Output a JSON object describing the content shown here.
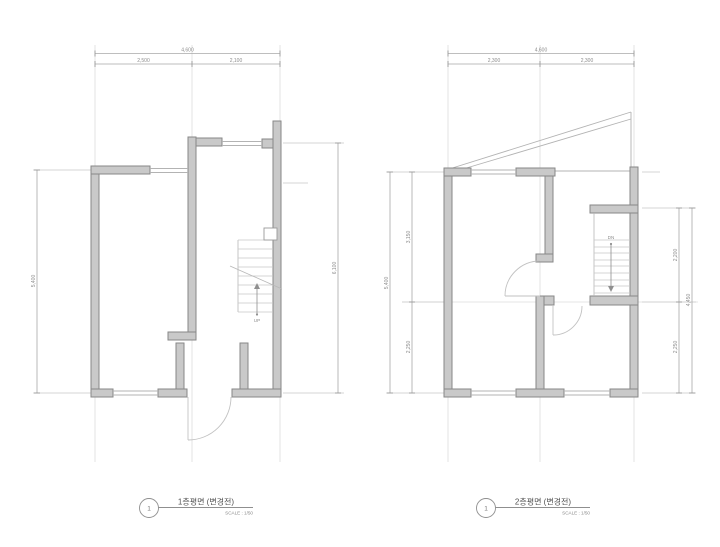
{
  "sheet": {
    "type": "architectural floor plan drawing",
    "background": "#ffffff"
  },
  "colors": {
    "wall_fill": "#c9c9c9",
    "wall_stroke": "#878787",
    "dim_line": "#a8a8a8",
    "light_line": "#c9c9c9",
    "dim_text": "#8d8d8d",
    "title_text": "#4f4f4f"
  },
  "plan1": {
    "number": "1",
    "title": "1층평면 (변경전)",
    "scale_label": "SCALE : 1/50",
    "up_label": "UP",
    "dim_top_total": "4,600",
    "dim_top_left": "2,500",
    "dim_top_right": "2,100",
    "dim_left": "5,400",
    "dim_right": "6,100"
  },
  "plan2": {
    "number": "1",
    "title": "2층평면 (변경전)",
    "scale_label": "SCALE : 1/50",
    "dn_label": "DN",
    "dim_top_total": "4,600",
    "dim_top_left": "2,300",
    "dim_top_right": "2,300",
    "dim_left_total": "5,400",
    "dim_left_upper": "3,150",
    "dim_left_lower": "2,250",
    "dim_right_total": "4,450",
    "dim_right_upper": "2,200",
    "dim_right_lower": "2,250"
  }
}
